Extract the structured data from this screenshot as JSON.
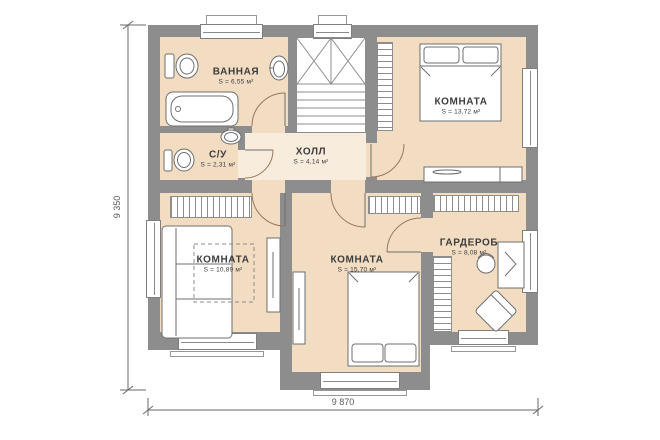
{
  "plan": {
    "rooms": {
      "bathroom": {
        "label": "ВАННАЯ",
        "area": "S = 6,55 м²"
      },
      "wc": {
        "label": "С/У",
        "area": "S = 2,31 м²"
      },
      "hall": {
        "label": "ХОЛЛ",
        "area": "S = 4,14 м²"
      },
      "bedroom_top": {
        "label": "КОМНАТА",
        "area": "S = 13,72 м²"
      },
      "bedroom_left": {
        "label": "КОМНАТА",
        "area": "S = 10,89 м²"
      },
      "bedroom_center": {
        "label": "КОМНАТА",
        "area": "S = 15,70 м²"
      },
      "wardrobe": {
        "label": "ГАРДЕРОБ",
        "area": "S = 8,08 м²"
      }
    },
    "dimensions": {
      "vertical": "9 350",
      "horizontal": "9 870"
    }
  },
  "colors": {
    "wall": "#8d8d8d",
    "floor": "#f2dcc2",
    "floor_light": "#f8ecdd",
    "door": "#97775c",
    "text": "#3d3d3d",
    "dim": "#5a5a5a"
  }
}
